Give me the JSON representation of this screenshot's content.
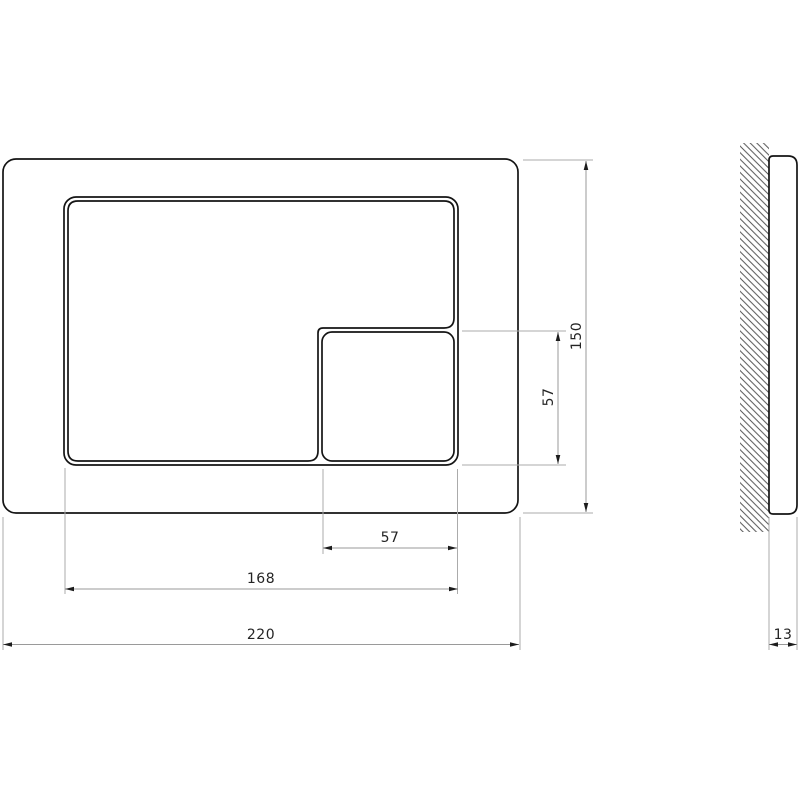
{
  "page": {
    "background_color": "#ffffff",
    "description": "Technical dimension drawing of a wall-mounted toilet flush plate, front view and side section view"
  },
  "drawing": {
    "colors": {
      "outline": "#141414",
      "dimension_line": "#9a9a9a",
      "extension_line": "#ababab",
      "dimension_text": "#242424",
      "hatch": "#555555"
    },
    "front_view": {
      "name": "flush-plate-front-view",
      "parts": {
        "plate": "outer plate outline",
        "recess": "button recess outline",
        "large_button": "large L-shaped flush button",
        "small_button": "small square flush button"
      }
    },
    "side_view": {
      "name": "flush-plate-side-view",
      "parts": {
        "wall": "hatched wall section",
        "plate_profile": "plate thickness profile"
      }
    },
    "dimensions": {
      "plate_width": "220",
      "plate_height": "150",
      "button_area_width": "168",
      "small_button_width": "57",
      "small_button_height": "57",
      "plate_depth": "13"
    }
  }
}
